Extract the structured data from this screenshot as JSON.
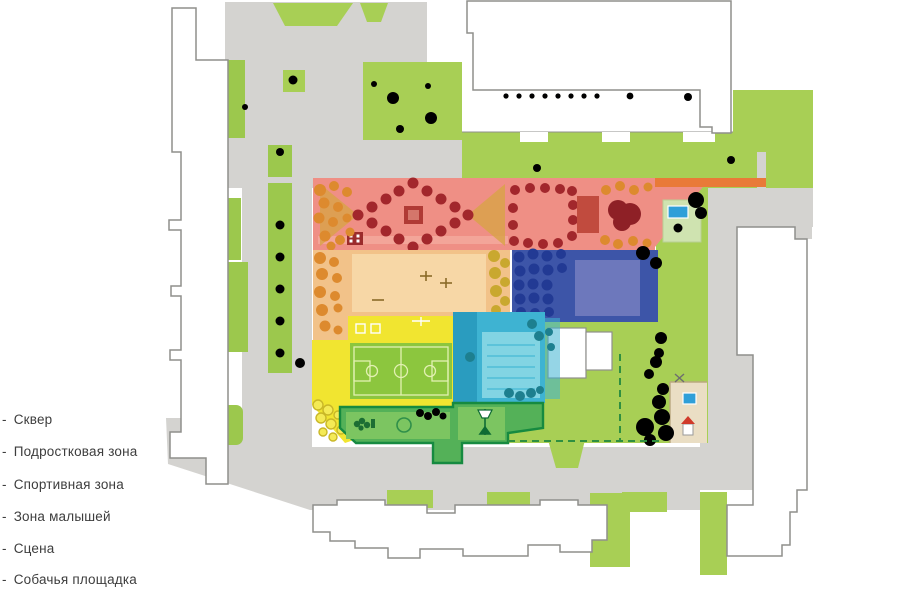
{
  "legend": {
    "marker": "-",
    "items": [
      {
        "id": "skver",
        "label": "Сквер",
        "color": "#ef8f85"
      },
      {
        "id": "teen",
        "label": "Подростковая зона",
        "color": "#f2c289"
      },
      {
        "id": "sport",
        "label": "Спортивная зона",
        "color": "#f1e530"
      },
      {
        "id": "kids",
        "label": "Зона малышей",
        "color": "#3eb3d2"
      },
      {
        "id": "stage",
        "label": "Сцена",
        "color": "#54b158"
      },
      {
        "id": "dog",
        "label": "Собачья площадка",
        "color": "#eadec4"
      }
    ]
  },
  "colors": {
    "path": "#d4d3d0",
    "grass": "#a8cf55",
    "grass2": "#9cc84d",
    "pink": "#ef8f85",
    "pinklight": "#f5b0a5",
    "redtree": "#a2272c",
    "redtreedark": "#8e2026",
    "orangetree": "#dd8a2e",
    "hatch": "#d9a24a",
    "tan": "#f2c289",
    "tanlight": "#f7d7a6",
    "yellowtree": "#c9a82f",
    "yellow": "#f1e530",
    "court": "#8cc63e",
    "courtline": "#e2f0b2",
    "blue": "#3d55a8",
    "bluetree": "#223a94",
    "bluelight": "#6d78bc",
    "cyan": "#3eb3d2",
    "cyandark": "#2a9cbf",
    "cyanlight": "#8ed9e6",
    "dgreenborder": "#168a40",
    "dgreenfill": "#54b158",
    "dgreenlight": "#7cc561",
    "dashgreen": "#2f8f40",
    "sand": "#eadec4",
    "pool": "#2f9fd8",
    "ostrip": "#e97a38",
    "bfill": "#ffffff",
    "bstroke": "#8f8f8c",
    "text": "#3d3d3d"
  }
}
